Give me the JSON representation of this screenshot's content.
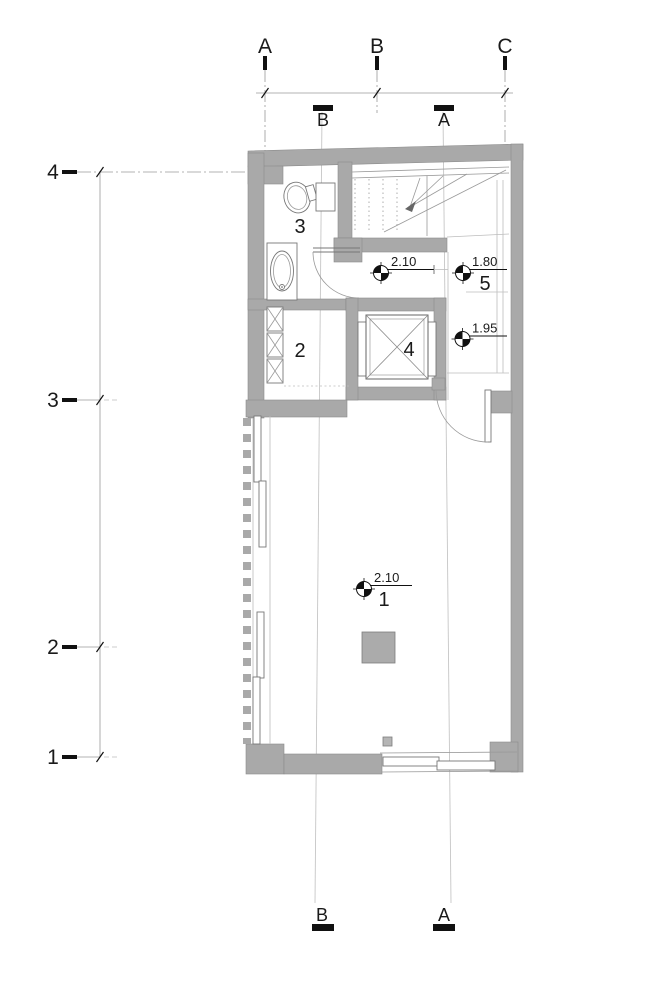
{
  "drawing_type": "architectural floor plan",
  "colors": {
    "wall": "#a9a9a9",
    "thin_line": "#9a9a9a",
    "section_line": "#c6c6c6",
    "text": "#1a1a1a",
    "background": "#ffffff"
  },
  "grid_columns": [
    {
      "label": "A"
    },
    {
      "label": "B"
    },
    {
      "label": "C"
    }
  ],
  "grid_rows": [
    {
      "label": "4"
    },
    {
      "label": "3"
    },
    {
      "label": "2"
    },
    {
      "label": "1"
    }
  ],
  "sections_top": [
    {
      "label": "B"
    },
    {
      "label": "A"
    }
  ],
  "sections_bottom": [
    {
      "label": "B"
    },
    {
      "label": "A"
    }
  ],
  "room_labels": [
    {
      "number": "3"
    },
    {
      "number": "2"
    },
    {
      "number": "4"
    }
  ],
  "level_markers": [
    {
      "value": "2.10",
      "room_number": ""
    },
    {
      "value": "1.80",
      "room_number": "5"
    },
    {
      "value": "1.95",
      "room_number": ""
    },
    {
      "value": "2.10",
      "room_number": "1"
    }
  ]
}
